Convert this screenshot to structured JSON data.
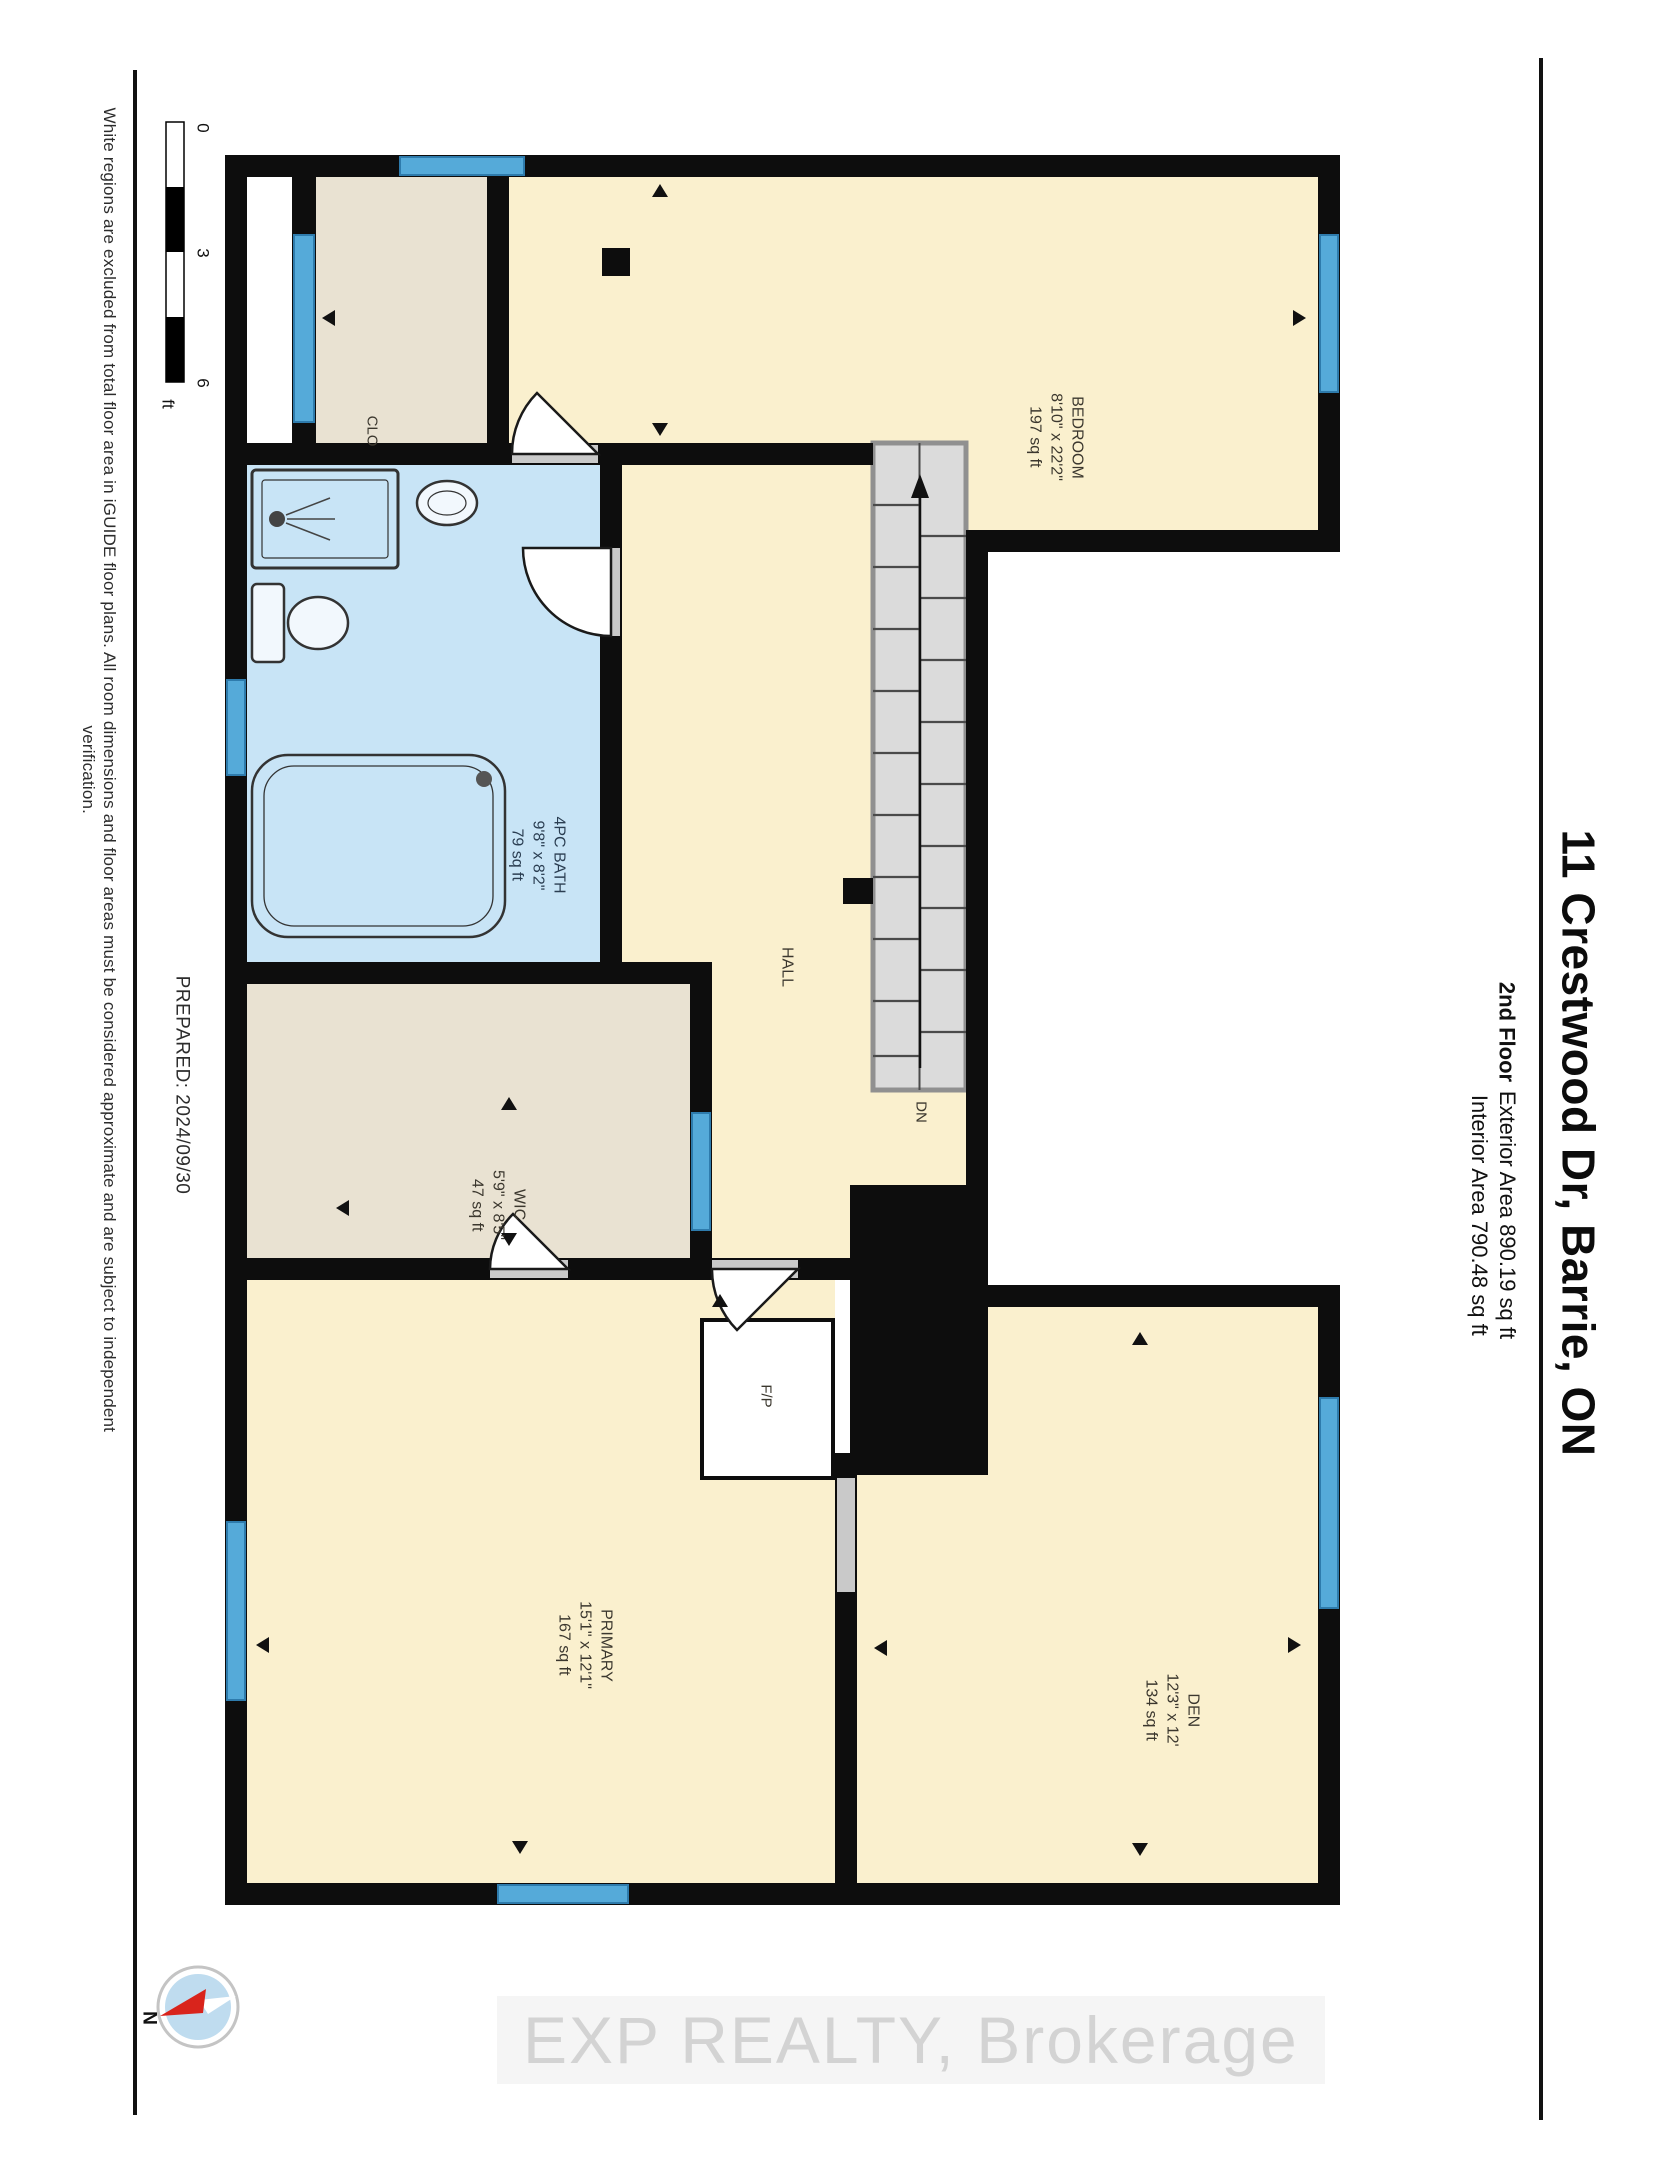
{
  "page": {
    "title": "11 Crestwood Dr, Barrie, ON",
    "floor": "2nd Floor",
    "areas": "Exterior Area 890.19 sq ft\nInterior Area 790.48 sq ft",
    "prepared": "PREPARED: 2024/09/30",
    "disclaimer": "White regions are excluded from total floor area in iGUIDE floor plans. All room dimensions and floor areas must be considered approximate and are subject to independent verification.",
    "watermark": "EXP REALTY, Brokerage"
  },
  "scale_bar": {
    "tick0": "0",
    "tick3": "3",
    "tick6": "6",
    "unit": "ft"
  },
  "compass": {
    "north": "N"
  },
  "rooms": {
    "bedroom": {
      "label": "BEDROOM\n8'10\" x 22'2\"\n197 sq ft"
    },
    "clo": {
      "label": "CLO"
    },
    "bath": {
      "label": "4PC BATH\n9'8\" x 8'2\"\n79 sq ft"
    },
    "wic": {
      "label": "WIC\n5'9\" x 8'5\"\n47 sq ft"
    },
    "hall": {
      "label": "HALL"
    },
    "primary": {
      "label": "PRIMARY\n15'1\" x 12'1\"\n167 sq ft"
    },
    "den": {
      "label": "DEN\n12'3\" x 12'\n134 sq ft"
    },
    "fireplace": {
      "label": "F/P"
    },
    "stairs": {
      "label": "DN"
    }
  },
  "colors": {
    "room_yellow": "#FAF0CE",
    "room_beige": "#E9E2D2",
    "bath_blue": "#C8E4F6",
    "window_blue": "#55AAD9",
    "door_gray": "#C9C9C9",
    "stair_gray": "#DBDBDB",
    "wall_black": "#0d0d0d"
  }
}
